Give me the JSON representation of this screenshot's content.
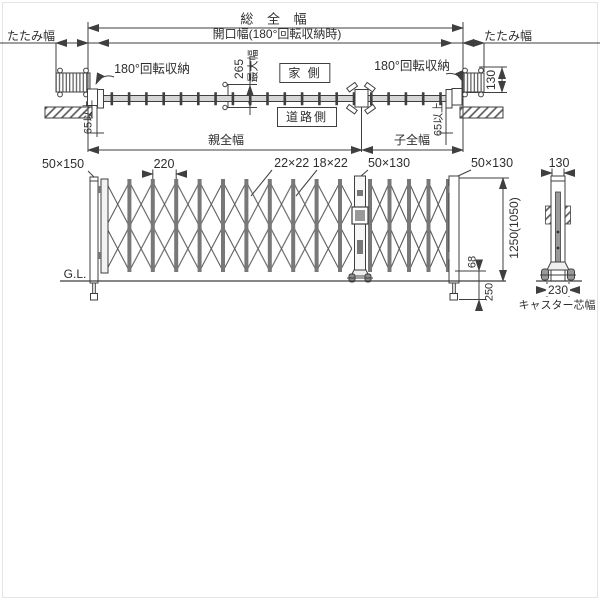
{
  "plan": {
    "total_width": "総 全 幅",
    "opening_width": "開口幅(180°回転収納時)",
    "fold_width_left": "たたみ幅",
    "fold_width_right": "たたみ幅",
    "rotation_left": "180°回転収納",
    "rotation_right": "180°回転収納",
    "max_width_value": "265",
    "max_width_label": "最大幅",
    "house_side": "家 側",
    "road_side": "道路側",
    "clearance_left": "65以上",
    "clearance_right": "65以上",
    "parent_width": "親全幅",
    "child_width": "子全幅",
    "unit_depth": "130"
  },
  "elevation": {
    "main_post_size": "50×150",
    "pitch": "220",
    "lattice_sizes": "22×22 18×22",
    "center_post_size": "50×130",
    "end_post_size": "50×130",
    "side_post_width": "130",
    "ground_line": "G.L.",
    "height": "1250(1050)",
    "caster_height": "68",
    "drop_depth": "250",
    "caster_core_width": "230",
    "caster_core_label": "キャスター芯幅"
  }
}
